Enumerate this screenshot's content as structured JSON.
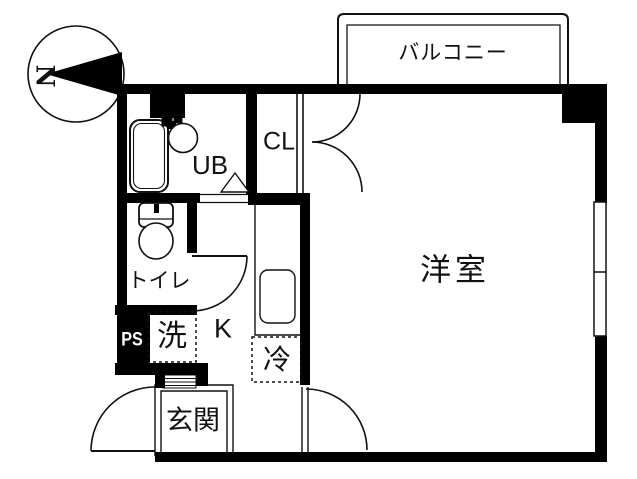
{
  "compass": {
    "north_label": "N"
  },
  "labels": {
    "balcony": "バルコニー",
    "closet": "CL",
    "unit_bath": "UB",
    "toilet": "トイレ",
    "pipe_space": "PS",
    "washing_machine": "洗",
    "kitchen": "K",
    "refrigerator": "冷",
    "entrance": "玄関",
    "western_room": "洋室"
  },
  "colors": {
    "wall": "#000000",
    "line": "#111111",
    "background": "#ffffff"
  }
}
